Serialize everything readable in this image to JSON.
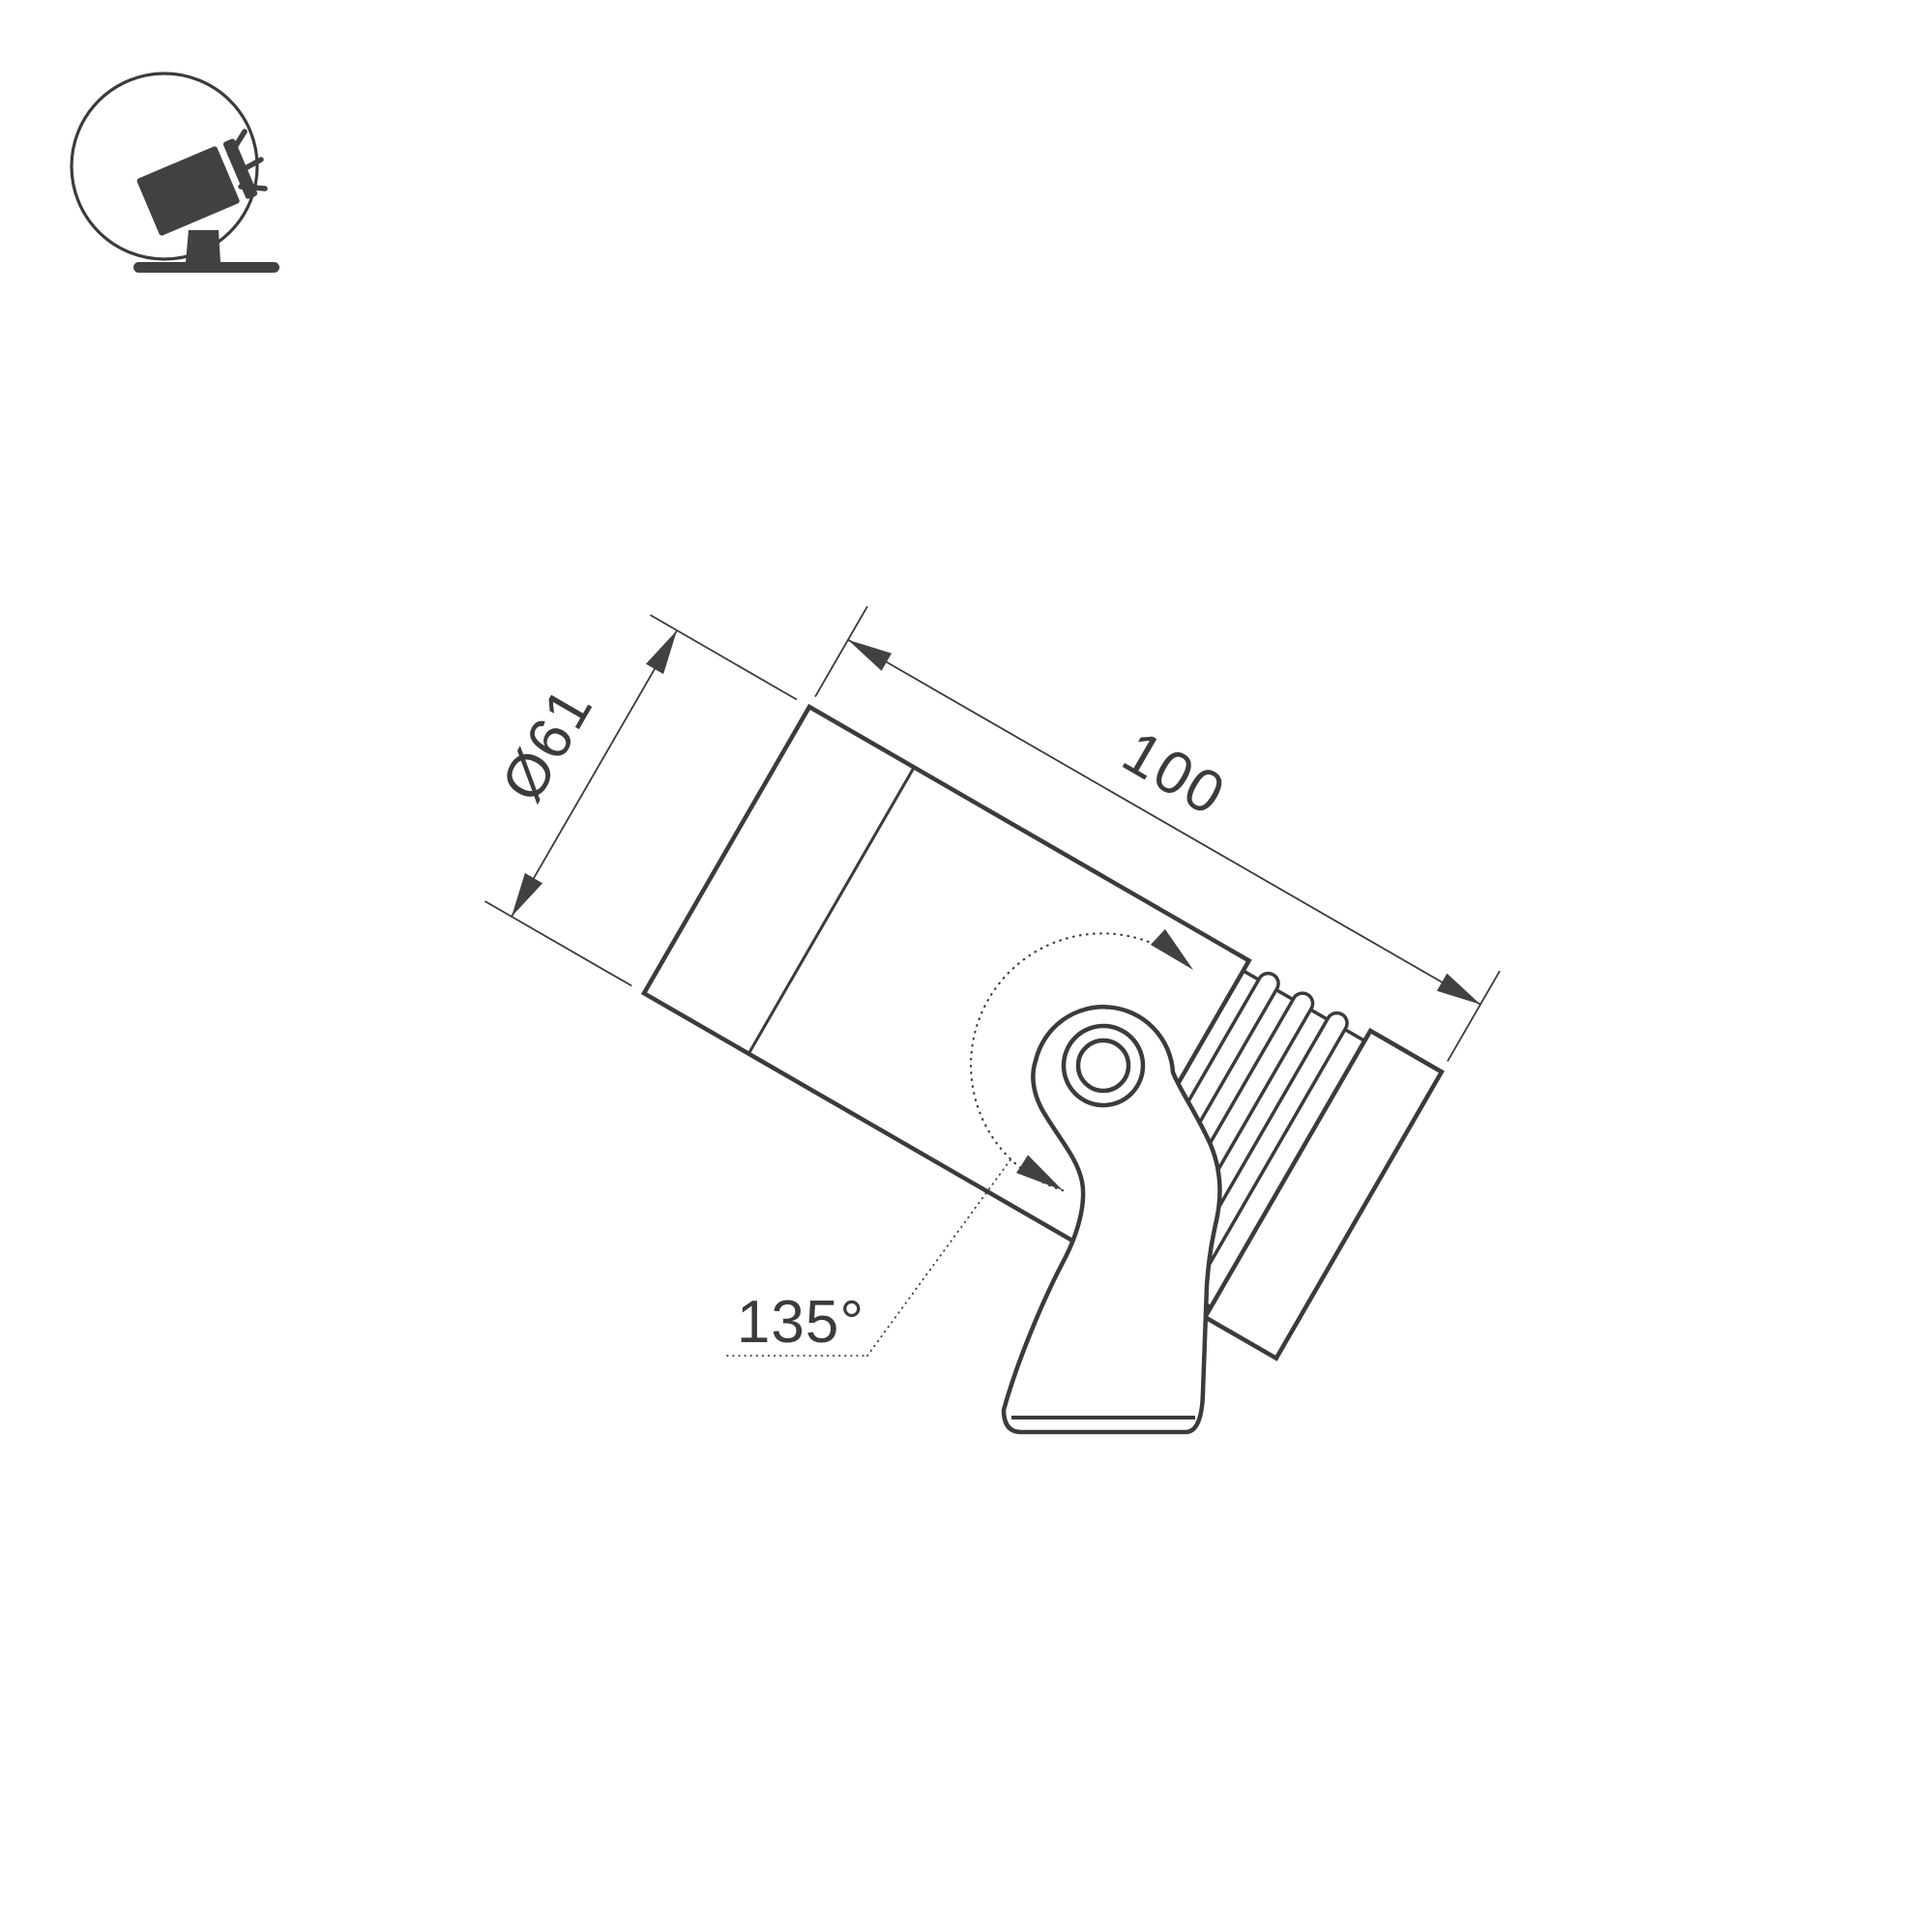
{
  "drawing": {
    "type": "technical-dimension-drawing",
    "subject": "adjustable surface-mounted spotlight, side view",
    "dimensions": {
      "diameter": {
        "label": "Ø61"
      },
      "length": {
        "label": "100"
      },
      "rotation": {
        "label": "135°"
      }
    }
  },
  "icon": {
    "name": "tilted-spotlight-icon",
    "description": "spotlight on stand emitting light rays, inside circle badge"
  },
  "colors": {
    "background": "#ffffff",
    "line": "#3b3b3d",
    "fill": "#414143"
  }
}
